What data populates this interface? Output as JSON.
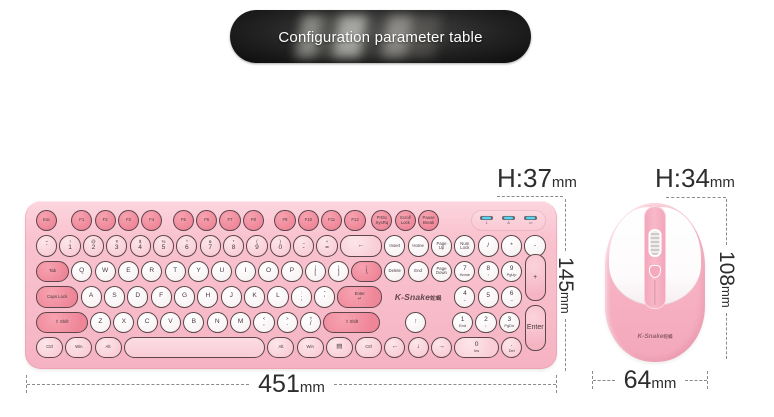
{
  "banner": {
    "title": "Configuration parameter table"
  },
  "annotations": {
    "keyboard_height": {
      "value": "H:37",
      "unit": "mm"
    },
    "keyboard_depth": {
      "value": "145",
      "unit": "mm"
    },
    "keyboard_width": {
      "value": "451",
      "unit": "mm"
    },
    "mouse_height": {
      "value": "H:34",
      "unit": "mm"
    },
    "mouse_depth": {
      "value": "108",
      "unit": "mm"
    },
    "mouse_width": {
      "value": "64",
      "unit": "mm"
    }
  },
  "colors": {
    "keyboard_body": "#f7bac8",
    "accent_key": "#ee8698",
    "light_key": "#f9ccd6",
    "white_key": "#ffffff",
    "led_indicator": "#55d6f2",
    "banner_bg": "#0b0b0b",
    "annotation_text": "#2d2d2d"
  },
  "keyboard": {
    "brand": "K-Snake",
    "brand_suffix": "蛇蝎",
    "indicator_leds": [
      {
        "icon": "num-lock-indicator",
        "glyph": "1"
      },
      {
        "icon": "caps-lock-indicator",
        "glyph": "A"
      },
      {
        "icon": "battery-indicator",
        "glyph": "▭"
      }
    ],
    "rows": [
      [
        {
          "l": "Esc",
          "t": "a",
          "sm": 1
        },
        {
          "g": 0.5
        },
        {
          "l": "F1",
          "t": "a",
          "sm": 1
        },
        {
          "l": "F2",
          "t": "a",
          "sm": 1
        },
        {
          "l": "F3",
          "t": "a",
          "sm": 1
        },
        {
          "l": "F4",
          "t": "a",
          "sm": 1
        },
        {
          "g": 0.35
        },
        {
          "l": "F5",
          "t": "a",
          "sm": 1
        },
        {
          "l": "F6",
          "t": "a",
          "sm": 1
        },
        {
          "l": "F7",
          "t": "a",
          "sm": 1
        },
        {
          "l": "F8",
          "t": "a",
          "sm": 1
        },
        {
          "g": 0.35
        },
        {
          "l": "F9",
          "t": "a",
          "sm": 1
        },
        {
          "l": "F10",
          "t": "a",
          "sm": 1
        },
        {
          "l": "F11",
          "t": "a",
          "sm": 1
        },
        {
          "l": "F12",
          "t": "a",
          "sm": 1
        },
        {
          "g": 0.15
        },
        {
          "s": "PrtSc",
          "l": "SysRq",
          "t": "a",
          "sm": 1
        },
        {
          "s": "Scroll",
          "l": "Lock",
          "t": "a",
          "sm": 1
        },
        {
          "s": "Pause",
          "l": "Break",
          "t": "a",
          "sm": 1
        },
        {
          "f": 1
        },
        {
          "panel": 1,
          "w": 3.2
        }
      ],
      [
        {
          "s": "~",
          "l": "`",
          "t": "l"
        },
        {
          "s": "!",
          "l": "1",
          "t": "l"
        },
        {
          "s": "@",
          "l": "2",
          "t": "l"
        },
        {
          "s": "#",
          "l": "3",
          "t": "l"
        },
        {
          "s": "$",
          "l": "4",
          "t": "l"
        },
        {
          "s": "%",
          "l": "5",
          "t": "l"
        },
        {
          "s": "^",
          "l": "6",
          "t": "l"
        },
        {
          "s": "&",
          "l": "7",
          "t": "l"
        },
        {
          "s": "*",
          "l": "8",
          "t": "l"
        },
        {
          "s": "(",
          "l": "9",
          "t": "l"
        },
        {
          "s": ")",
          "l": "0",
          "t": "l"
        },
        {
          "s": "_",
          "l": "-",
          "t": "l"
        },
        {
          "s": "+",
          "l": "=",
          "t": "l"
        },
        {
          "l": "←",
          "t": "l",
          "w": 1.9
        },
        {
          "l": "Insert",
          "t": "w",
          "sm": 1
        },
        {
          "l": "Home",
          "t": "w",
          "sm": 1
        },
        {
          "s": "Page",
          "l": "Up",
          "t": "w",
          "sm": 1
        },
        {
          "s": "Num",
          "l": "Lock",
          "t": "w",
          "sm": 1
        },
        {
          "l": "/",
          "t": "w"
        },
        {
          "l": "*",
          "t": "w"
        },
        {
          "l": "-",
          "t": "w"
        }
      ],
      [
        {
          "l": "Tab",
          "t": "m",
          "w": 1.5,
          "sm": 1
        },
        {
          "l": "Q",
          "t": "w"
        },
        {
          "l": "W",
          "t": "w"
        },
        {
          "l": "E",
          "t": "w"
        },
        {
          "l": "R",
          "t": "w"
        },
        {
          "l": "T",
          "t": "w"
        },
        {
          "l": "Y",
          "t": "w"
        },
        {
          "l": "U",
          "t": "w"
        },
        {
          "l": "I",
          "t": "w"
        },
        {
          "l": "O",
          "t": "w"
        },
        {
          "l": "P",
          "t": "w"
        },
        {
          "s": "{",
          "l": "[",
          "t": "w"
        },
        {
          "s": "}",
          "l": "]",
          "t": "w"
        },
        {
          "s": "|",
          "l": "\\",
          "t": "m",
          "w": 1.4
        },
        {
          "l": "Delete",
          "t": "w",
          "sm": 1
        },
        {
          "l": "End",
          "t": "w",
          "sm": 1
        },
        {
          "s": "Page",
          "l": "Down",
          "t": "w",
          "sm": 1
        },
        {
          "l": "7",
          "b": "Home",
          "t": "w"
        },
        {
          "l": "8",
          "b": "↑",
          "t": "w"
        },
        {
          "l": "9",
          "b": "PgUp",
          "t": "w"
        }
      ],
      [
        {
          "l": "Caps Lock",
          "t": "m",
          "w": 1.9,
          "sm": 1
        },
        {
          "l": "A",
          "t": "w"
        },
        {
          "l": "S",
          "t": "w"
        },
        {
          "l": "D",
          "t": "w"
        },
        {
          "l": "F",
          "t": "w"
        },
        {
          "l": "G",
          "t": "w"
        },
        {
          "l": "H",
          "t": "w"
        },
        {
          "l": "J",
          "t": "w"
        },
        {
          "l": "K",
          "t": "w"
        },
        {
          "l": "L",
          "t": "w"
        },
        {
          "s": ":",
          "l": ";",
          "t": "w"
        },
        {
          "s": "\"",
          "l": "'",
          "t": "w"
        },
        {
          "s": "Enter",
          "l": "↵",
          "t": "m",
          "w": 2.0,
          "sm": 1
        },
        {
          "logo": 1,
          "w": 3
        },
        {
          "l": "4",
          "b": "←",
          "t": "w"
        },
        {
          "l": "5",
          "t": "w"
        },
        {
          "l": "6",
          "b": "→",
          "t": "w"
        }
      ],
      [
        {
          "l": "⇧ Shift",
          "t": "m",
          "w": 2.3,
          "sm": 1
        },
        {
          "l": "Z",
          "t": "w"
        },
        {
          "l": "X",
          "t": "w"
        },
        {
          "l": "C",
          "t": "w"
        },
        {
          "l": "V",
          "t": "w"
        },
        {
          "l": "B",
          "t": "w"
        },
        {
          "l": "N",
          "t": "w"
        },
        {
          "l": "M",
          "t": "w"
        },
        {
          "s": "<",
          "l": ",",
          "t": "w"
        },
        {
          "s": ">",
          "l": ".",
          "t": "w"
        },
        {
          "s": "?",
          "l": "/",
          "t": "w"
        },
        {
          "l": "⇧ Shift",
          "t": "m",
          "w": 2.5,
          "sm": 1
        },
        {
          "g": 1
        },
        {
          "l": "↑",
          "t": "w"
        },
        {
          "g": 1
        },
        {
          "l": "1",
          "b": "End",
          "t": "w"
        },
        {
          "l": "2",
          "b": "↓",
          "t": "w"
        },
        {
          "l": "3",
          "b": "PgDn",
          "t": "w"
        }
      ],
      [
        {
          "l": "Ctrl",
          "t": "l",
          "w": 1.25,
          "sm": 1
        },
        {
          "l": "Win",
          "t": "l",
          "w": 1.25,
          "sm": 1
        },
        {
          "l": "Alt",
          "t": "l",
          "w": 1.25,
          "sm": 1
        },
        {
          "l": "",
          "t": "sp",
          "w": 6.15
        },
        {
          "l": "Alt",
          "t": "l",
          "w": 1.25,
          "sm": 1
        },
        {
          "l": "Win",
          "t": "l",
          "w": 1.25,
          "sm": 1
        },
        {
          "l": "▤",
          "t": "l",
          "w": 1.25
        },
        {
          "l": "Ctrl",
          "t": "l",
          "w": 1.25,
          "sm": 1
        },
        {
          "l": "←",
          "t": "l"
        },
        {
          "l": "↓",
          "t": "l"
        },
        {
          "l": "→",
          "t": "l"
        },
        {
          "l": "0",
          "b": "Ins",
          "t": "l",
          "w": 2
        },
        {
          "l": ".",
          "b": "Del",
          "t": "l"
        }
      ]
    ],
    "tall_keys": [
      {
        "l": "+",
        "rows": [
          2,
          3
        ]
      },
      {
        "l": "Enter",
        "rows": [
          4,
          5
        ]
      }
    ]
  },
  "mouse": {
    "brand": "K-Snake",
    "brand_suffix": "蛇蝎"
  }
}
